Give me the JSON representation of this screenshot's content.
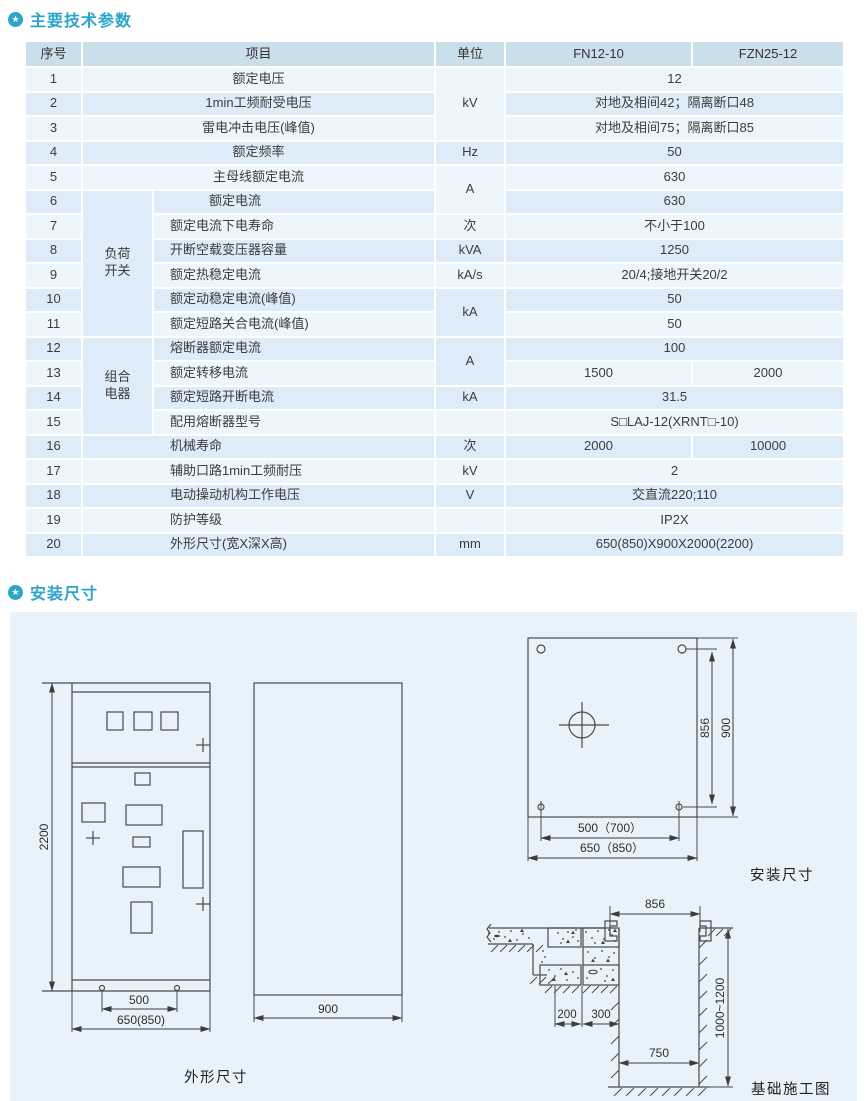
{
  "colors": {
    "accent": "#2ba6c9",
    "table_header_bg": "#cbdfea",
    "row_light": "#edf6fc",
    "row_dark": "#ddecf8",
    "panel_bg": "#e8f2fa"
  },
  "icons": {
    "section_badge": "★"
  },
  "sections": {
    "params_title": "主要技术参数",
    "install_title": "安装尺寸"
  },
  "table": {
    "headers": {
      "no": "序号",
      "item": "项目",
      "unit": "单位",
      "col1": "FN12-10",
      "col2": "FZN25-12"
    },
    "rows": [
      [
        {
          "t": "1"
        },
        {
          "t": "额定电压",
          "cs": 2
        },
        {
          "t": "kV",
          "rs": 3
        },
        {
          "t": "12",
          "cs": 2
        }
      ],
      [
        {
          "t": "2"
        },
        {
          "t": "1min工频耐受电压",
          "cs": 2
        },
        {
          "t": "对地及相间42；隔离断口48",
          "cs": 2
        }
      ],
      [
        {
          "t": "3"
        },
        {
          "t": "雷电冲击电压(峰值)",
          "cs": 2
        },
        {
          "t": "对地及相间75；隔离断口85",
          "cs": 2
        }
      ],
      [
        {
          "t": "4"
        },
        {
          "t": "额定频率",
          "cs": 2
        },
        {
          "t": "Hz"
        },
        {
          "t": "50",
          "cs": 2
        }
      ],
      [
        {
          "t": "5"
        },
        {
          "t": "主母线额定电流",
          "cs": 2
        },
        {
          "t": "A",
          "rs": 2
        },
        {
          "t": "630",
          "cs": 2
        }
      ],
      [
        {
          "t": "6"
        },
        {
          "t": "负荷\n开关",
          "rs": 6,
          "cl": "grp"
        },
        {
          "t": "额定电流",
          "cl": "il2"
        },
        {
          "t": "630",
          "cs": 2
        }
      ],
      [
        {
          "t": "7"
        },
        {
          "t": "额定电流下电寿命",
          "cl": "il"
        },
        {
          "t": "次"
        },
        {
          "t": "不小于100",
          "cs": 2
        }
      ],
      [
        {
          "t": "8"
        },
        {
          "t": "开断空载变压器容量",
          "cl": "il"
        },
        {
          "t": "kVA"
        },
        {
          "t": "1250",
          "cs": 2
        }
      ],
      [
        {
          "t": "9"
        },
        {
          "t": "额定热稳定电流",
          "cl": "il"
        },
        {
          "t": "kA/s"
        },
        {
          "t": "20/4;接地开关20/2",
          "cs": 2
        }
      ],
      [
        {
          "t": "10"
        },
        {
          "t": "额定动稳定电流(峰值)",
          "cl": "il"
        },
        {
          "t": "kA",
          "rs": 2
        },
        {
          "t": "50",
          "cs": 2
        }
      ],
      [
        {
          "t": "11"
        },
        {
          "t": "额定短路关合电流(峰值)",
          "cl": "il"
        },
        {
          "t": "50",
          "cs": 2
        }
      ],
      [
        {
          "t": "12"
        },
        {
          "t": "组合\n电器",
          "rs": 4,
          "cl": "grp"
        },
        {
          "t": "熔断器额定电流",
          "cl": "il"
        },
        {
          "t": "A",
          "rs": 2
        },
        {
          "t": "100",
          "cs": 2
        }
      ],
      [
        {
          "t": "13"
        },
        {
          "t": "额定转移电流",
          "cl": "il"
        },
        {
          "t": "1500"
        },
        {
          "t": "2000"
        }
      ],
      [
        {
          "t": "14"
        },
        {
          "t": "额定短路开断电流",
          "cl": "il"
        },
        {
          "t": "kA"
        },
        {
          "t": "31.5",
          "cs": 2
        }
      ],
      [
        {
          "t": "15"
        },
        {
          "t": "配用熔断器型号",
          "cl": "il"
        },
        {
          "t": ""
        },
        {
          "t": "S□LAJ-12(XRNT□-10)",
          "cs": 2
        }
      ],
      [
        {
          "t": "16"
        },
        {
          "t": "机械寿命",
          "cs": 2,
          "cl": "iw"
        },
        {
          "t": "次"
        },
        {
          "t": "2000"
        },
        {
          "t": "10000"
        }
      ],
      [
        {
          "t": "17"
        },
        {
          "t": "辅助口路1min工频耐压",
          "cs": 2,
          "cl": "iw"
        },
        {
          "t": "kV"
        },
        {
          "t": "2",
          "cs": 2
        }
      ],
      [
        {
          "t": "18"
        },
        {
          "t": "电动操动机构工作电压",
          "cs": 2,
          "cl": "iw"
        },
        {
          "t": "V"
        },
        {
          "t": "交直流220;110",
          "cs": 2
        }
      ],
      [
        {
          "t": "19"
        },
        {
          "t": "防护等级",
          "cs": 2,
          "cl": "iw"
        },
        {
          "t": ""
        },
        {
          "t": "IP2X",
          "cs": 2
        }
      ],
      [
        {
          "t": "20"
        },
        {
          "t": "外形尺寸(宽X深X高)",
          "cs": 2,
          "cl": "iw"
        },
        {
          "t": "mm"
        },
        {
          "t": "650(850)X900X2000(2200)",
          "cs": 2
        }
      ]
    ]
  },
  "drawings": {
    "outline": {
      "label": "外形尺寸",
      "height": "2200",
      "hole_span": "500",
      "width": "650(850)",
      "depth": "900"
    },
    "plan": {
      "label": "安装尺寸",
      "hole_height": "856",
      "depth": "900",
      "hole_span": "500（700）",
      "width": "650（850）"
    },
    "foundation": {
      "label": "基础施工图",
      "top_width": "856",
      "dim_200": "200",
      "dim_300": "300",
      "bottom_width": "750",
      "depth": "1000~1200"
    }
  }
}
